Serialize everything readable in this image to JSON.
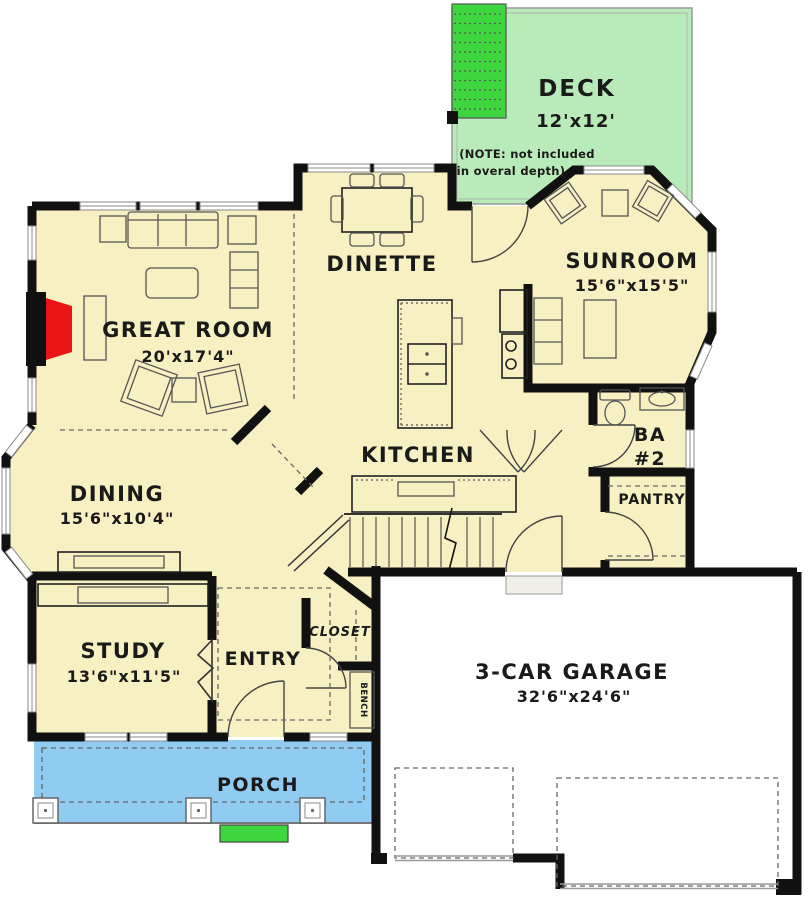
{
  "plan": {
    "title": "first-floor-plan",
    "rooms": {
      "deck": {
        "name": "DECK",
        "dims": "12'x12'",
        "note_line1": "(NOTE: not included",
        "note_line2": "in overal depth)"
      },
      "great_room": {
        "name": "GREAT ROOM",
        "dims": "20'x17'4\""
      },
      "dinette": {
        "name": "DINETTE"
      },
      "sunroom": {
        "name": "SUNROOM",
        "dims": "15'6\"x15'5\""
      },
      "kitchen": {
        "name": "KITCHEN"
      },
      "dining": {
        "name": "DINING",
        "dims": "15'6\"x10'4\""
      },
      "bath2": {
        "name_line1": "BA",
        "name_line2": "#2"
      },
      "pantry": {
        "name": "PANTRY"
      },
      "study": {
        "name": "STUDY",
        "dims": "13'6\"x11'5\""
      },
      "entry": {
        "name": "ENTRY"
      },
      "closet": {
        "name": "CLOSET"
      },
      "bench": {
        "name": "BENCH"
      },
      "garage": {
        "name": "3-CAR GARAGE",
        "dims": "32'6\"x24'6\""
      },
      "porch": {
        "name": "PORCH"
      }
    },
    "colors": {
      "floor": "#f7f0c2",
      "deck": "#b9eab9",
      "deck_stairs": "#3ed63e",
      "porch": "#90cbf1",
      "front_step": "#3ed63e",
      "fireplace": "#e91414",
      "wall": "#111111",
      "background": "#ffffff"
    }
  }
}
